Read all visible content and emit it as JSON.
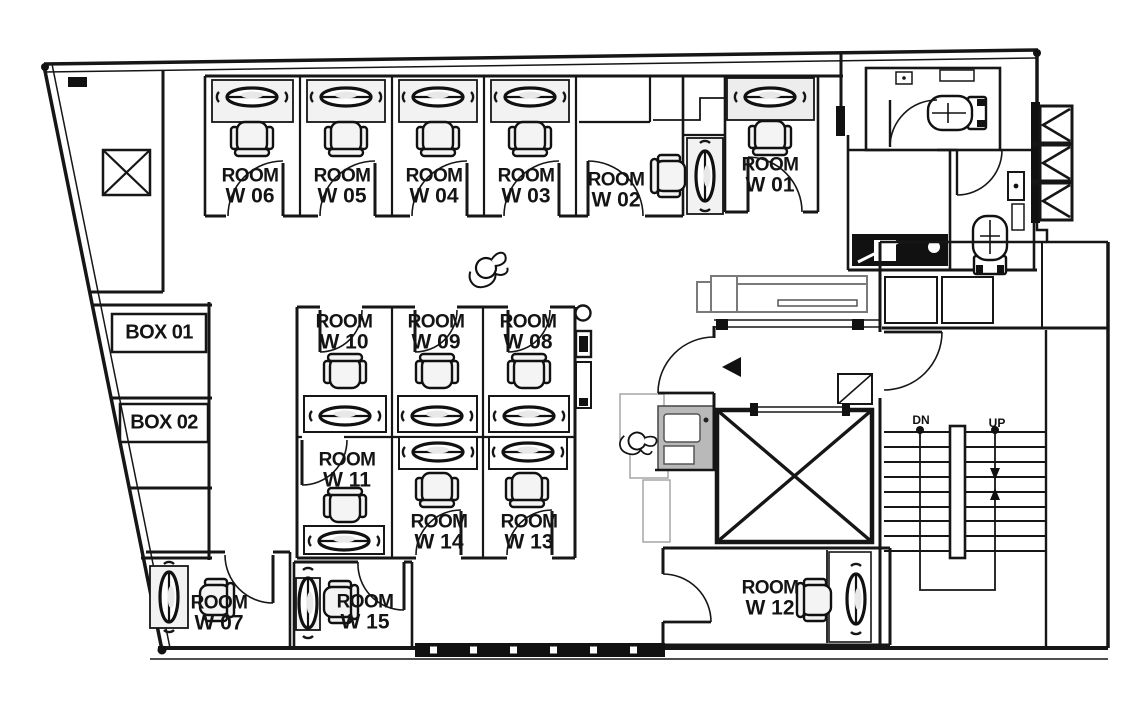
{
  "drawing": {
    "type": "office-floor-plan",
    "background": "#ffffff",
    "line_color": "#161616",
    "desk_fill": "#f2f2f2",
    "gray_outline": "#a0a0a0",
    "sofa_stroke": "#7a7a7a"
  },
  "rooms": [
    {
      "id": "w06",
      "name": "ROOM",
      "number": "W 06"
    },
    {
      "id": "w05",
      "name": "ROOM",
      "number": "W 05"
    },
    {
      "id": "w04",
      "name": "ROOM",
      "number": "W 04"
    },
    {
      "id": "w03",
      "name": "ROOM",
      "number": "W 03"
    },
    {
      "id": "w02",
      "name": "ROOM",
      "number": "W 02"
    },
    {
      "id": "w01",
      "name": "ROOM",
      "number": "W 01"
    },
    {
      "id": "w10",
      "name": "ROOM",
      "number": "W 10"
    },
    {
      "id": "w09",
      "name": "ROOM",
      "number": "W 09"
    },
    {
      "id": "w08",
      "name": "ROOM",
      "number": "W 08"
    },
    {
      "id": "w11",
      "name": "ROOM",
      "number": "W 11"
    },
    {
      "id": "w14",
      "name": "ROOM",
      "number": "W 14"
    },
    {
      "id": "w13",
      "name": "ROOM",
      "number": "W 13"
    },
    {
      "id": "w07",
      "name": "ROOM",
      "number": "W 07"
    },
    {
      "id": "w15",
      "name": "ROOM",
      "number": "W 15"
    },
    {
      "id": "w12",
      "name": "ROOM",
      "number": "W 12"
    }
  ],
  "boxes": [
    {
      "label": "BOX 01"
    },
    {
      "label": "BOX 02"
    }
  ],
  "stairs": {
    "down_label": "DN",
    "up_label": "UP"
  },
  "icons": {
    "elevator": "x-crossed-box",
    "shaft": "x-crossed-box",
    "vent-louver": "chevron-box",
    "toilet": "toilet-plan-symbol",
    "desk": "oval-on-rectangle",
    "chair": "rounded-square-with-armrests",
    "sofa": "rectangle-with-back",
    "person": "top-view-figure",
    "door": "quarter-circle-swing",
    "stairs": "parallel-treads"
  }
}
